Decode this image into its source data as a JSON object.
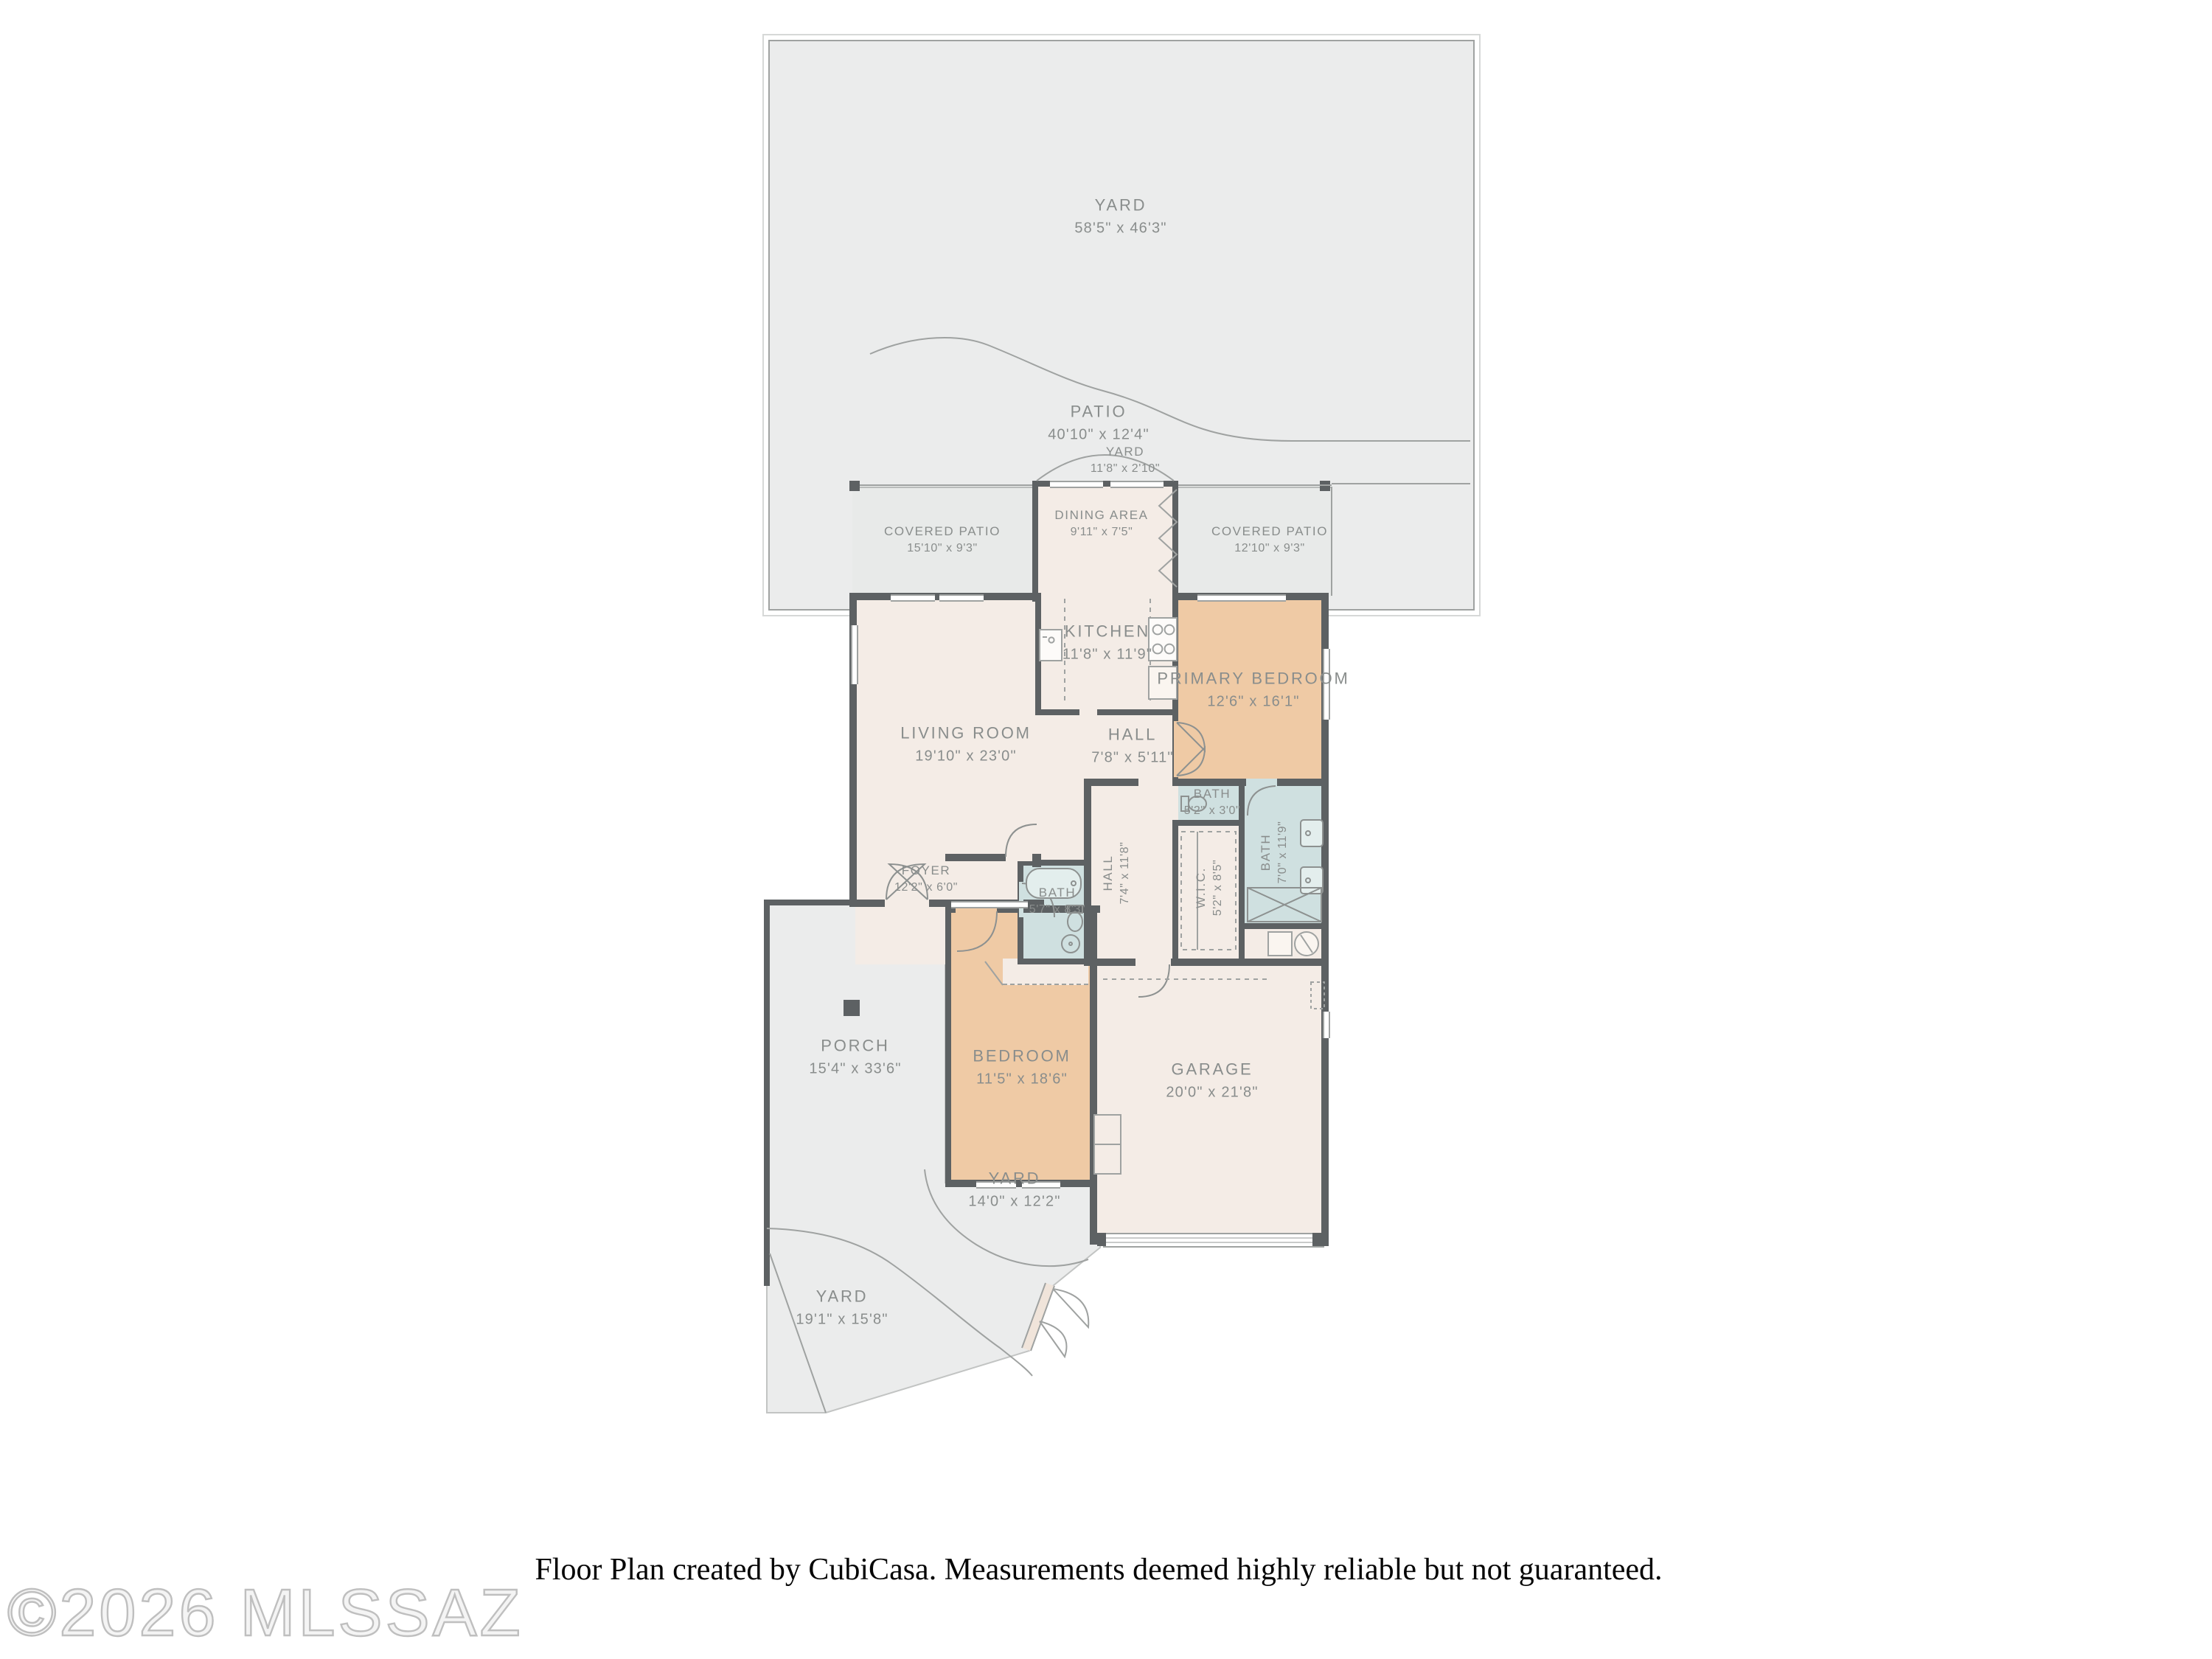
{
  "plan": {
    "rooms": {
      "yard_top": {
        "name": "YARD",
        "dims": "58'5\" x 46'3\""
      },
      "patio": {
        "name": "PATIO",
        "dims": "40'10\" x 12'4\""
      },
      "yard_small": {
        "name": "YARD",
        "dims": "11'8\" x 2'10\""
      },
      "covered_patio_l": {
        "name": "COVERED PATIO",
        "dims": "15'10\" x 9'3\""
      },
      "dining": {
        "name": "DINING AREA",
        "dims": "9'11\" x 7'5\""
      },
      "covered_patio_r": {
        "name": "COVERED PATIO",
        "dims": "12'10\" x 9'3\""
      },
      "kitchen": {
        "name": "KITCHEN",
        "dims": "11'8\" x 11'9\""
      },
      "primary_bedroom": {
        "name": "PRIMARY BEDROOM",
        "dims": "12'6\" x 16'1\""
      },
      "living_room": {
        "name": "LIVING ROOM",
        "dims": "19'10\" x 23'0\""
      },
      "hall_upper": {
        "name": "HALL",
        "dims": "7'8\" x 5'11\""
      },
      "bath_small": {
        "name": "BATH",
        "dims": "5'2\" x 3'0\""
      },
      "hall_lower": {
        "name": "HALL",
        "dims": "7'4\" x 11'8\""
      },
      "wic": {
        "name": "W.I.C.",
        "dims": "5'2\" x 8'5\""
      },
      "bath_primary": {
        "name": "BATH",
        "dims": "7'0\" x 11'9\""
      },
      "foyer": {
        "name": "FOYER",
        "dims": "12'2\" x 6'0\""
      },
      "bath_hall": {
        "name": "BATH",
        "dims": "5'7\" x 8'3\""
      },
      "porch": {
        "name": "PORCH",
        "dims": "15'4\" x 33'6\""
      },
      "bedroom": {
        "name": "BEDROOM",
        "dims": "11'5\" x 18'6\""
      },
      "garage": {
        "name": "GARAGE",
        "dims": "20'0\" x 21'8\""
      },
      "yard_mid": {
        "name": "YARD",
        "dims": "14'0\" x 12'2\""
      },
      "yard_bottom": {
        "name": "YARD",
        "dims": "19'1\" x 15'8\""
      }
    },
    "footer": "Floor Plan created by CubiCasa. Measurements deemed highly reliable but not guaranteed.",
    "watermark": "©2026 MLSSAZ",
    "colors": {
      "wall": "#5d6163",
      "floor": "#f4ece6",
      "bedroom": "#efcaa5",
      "bath": "#cfe0e0",
      "outdoor": "#ebecec",
      "covered": "#e8eae9",
      "line": "#9fa2a1",
      "label": "#898d8c"
    }
  }
}
